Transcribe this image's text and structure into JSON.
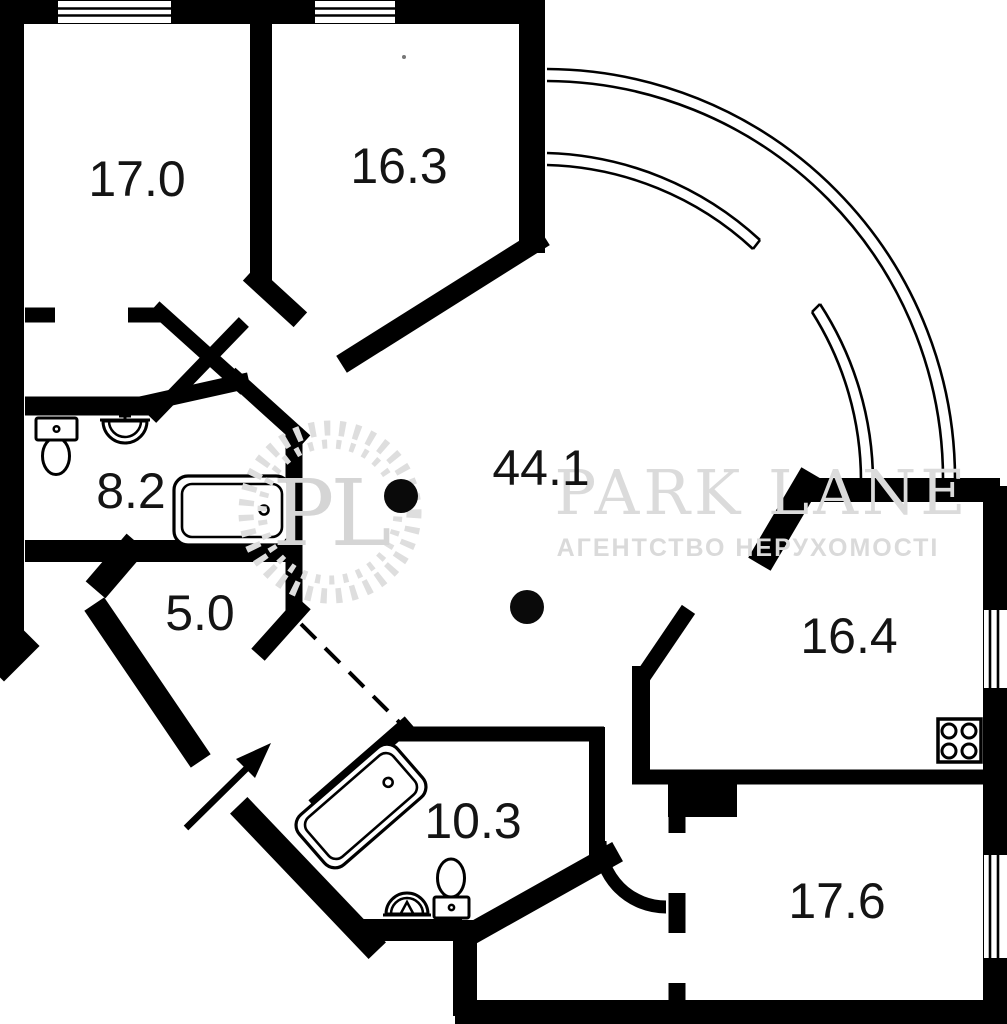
{
  "plan": {
    "type": "apartment-floor-plan",
    "total_label_unit": "m2"
  },
  "rooms": [
    {
      "name": "bedroom-top-left",
      "area": "17.0"
    },
    {
      "name": "bedroom-top-middle",
      "area": "16.3"
    },
    {
      "name": "living-hall",
      "area": "44.1"
    },
    {
      "name": "bathroom-left",
      "area": "8.2"
    },
    {
      "name": "hallway-small",
      "area": "5.0"
    },
    {
      "name": "kitchen-right",
      "area": "16.4"
    },
    {
      "name": "bathroom-bottom",
      "area": "10.3"
    },
    {
      "name": "room-bottom-right",
      "area": "17.6"
    }
  ],
  "watermark": {
    "monogram": "PL",
    "brand": "PARK LANE",
    "subtitle": "АГЕНТСТВО НЕРУХОМОСТІ"
  },
  "colors": {
    "wall": "#000000",
    "background": "#ffffff",
    "watermark": "#d9d9d9",
    "label": "#141414"
  },
  "icons": {
    "fixtures": [
      "toilet-icon",
      "sink-icon",
      "bathtub-icon",
      "stove-icon"
    ],
    "symbols": [
      "entrance-arrow-icon",
      "door-swing-arc",
      "window",
      "balcony-arc",
      "column-dot"
    ]
  }
}
